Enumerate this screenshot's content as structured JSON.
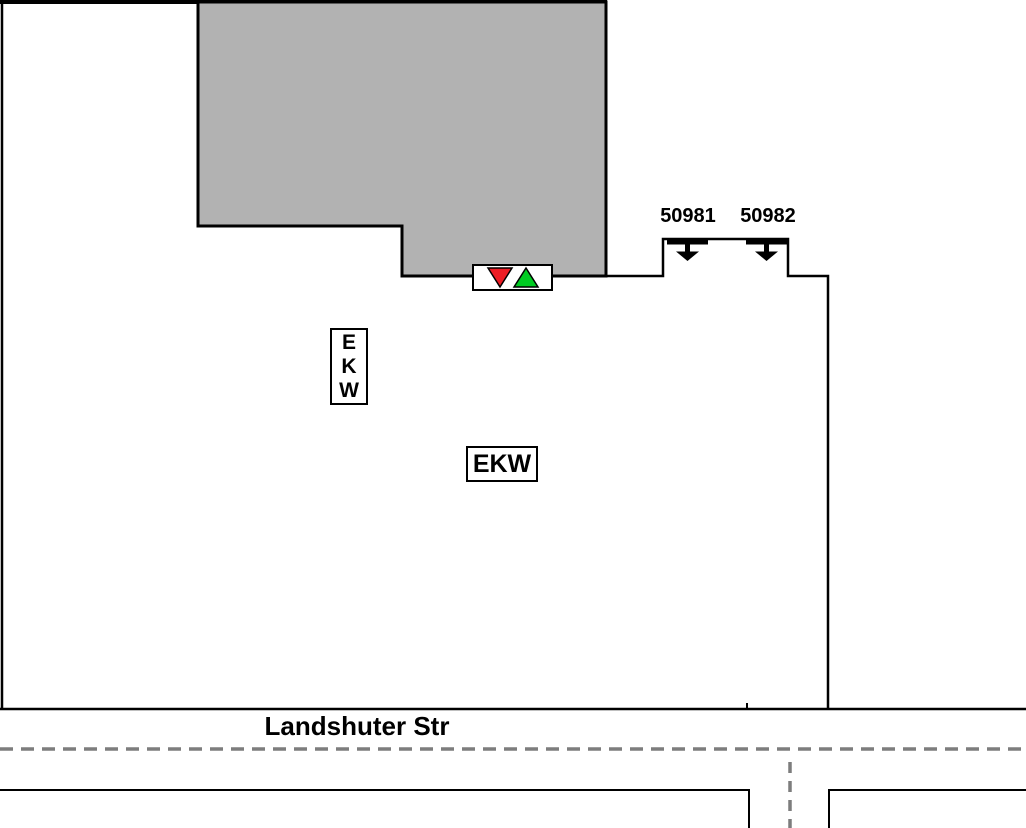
{
  "plan": {
    "street": {
      "name": "Landshuter Str"
    },
    "gates": [
      {
        "id": "50981"
      },
      {
        "id": "50982"
      }
    ],
    "labels": {
      "ekw_vertical": "E\nK\nW",
      "ekw_horizontal": "EKW"
    },
    "marker": {
      "symbols": [
        "down-triangle",
        "up-triangle"
      ]
    },
    "colors": {
      "background": "#ffffff",
      "building_fill": "#b2b2b2",
      "outline": "#000000",
      "centerline_gray": "#7d7d7d",
      "marker_red": "#ed1c24",
      "marker_green": "#00cc22"
    }
  }
}
